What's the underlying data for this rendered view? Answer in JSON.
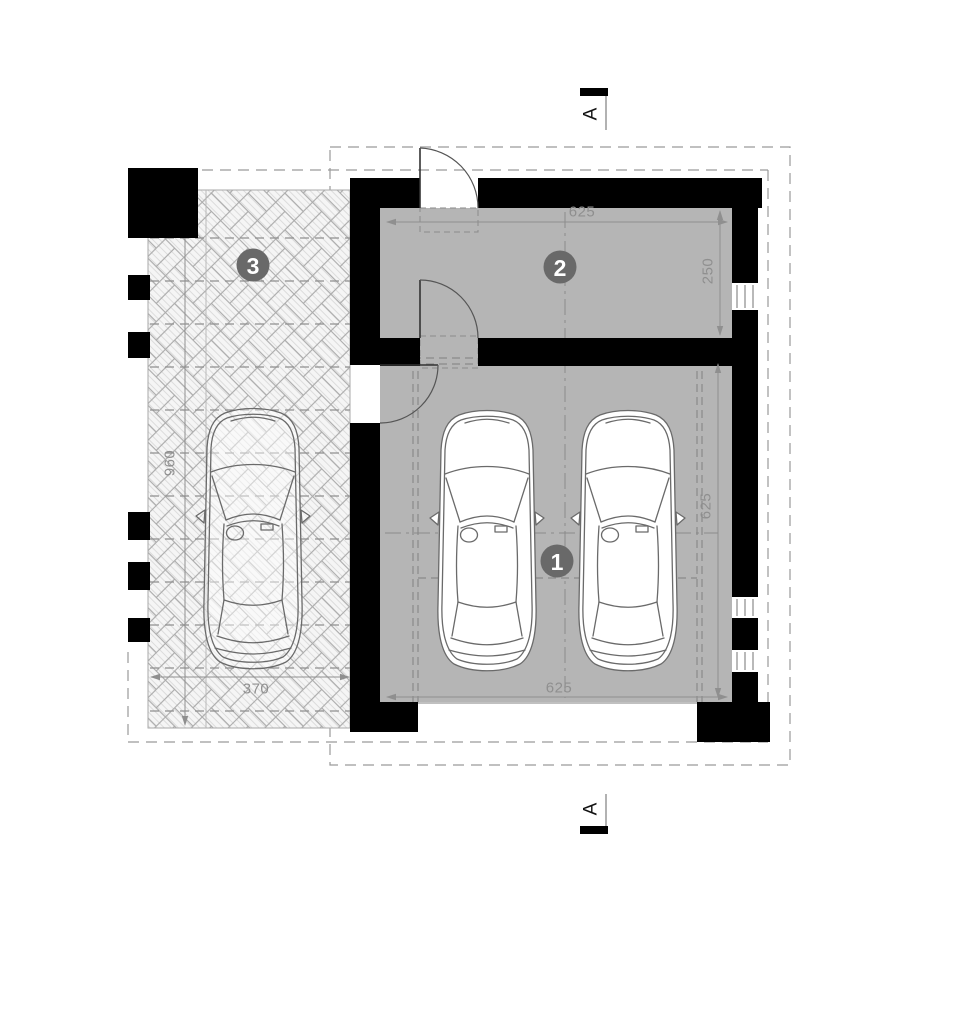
{
  "section": {
    "top_marker": "A",
    "bottom_marker": "A"
  },
  "rooms": {
    "r1": "1",
    "r2": "2",
    "r3": "3"
  },
  "dims": {
    "room2_width": "625",
    "room2_depth": "250",
    "room1_width": "625",
    "room1_depth": "625",
    "carport_width": "370",
    "carport_depth": "960"
  },
  "colors": {
    "wall": "#000000",
    "floor": "#b5b5b5",
    "label_circle": "#696969",
    "dimension": "#8f8f8f",
    "dashed_line": "#9a9a9a",
    "hatch_line": "#ababab"
  }
}
